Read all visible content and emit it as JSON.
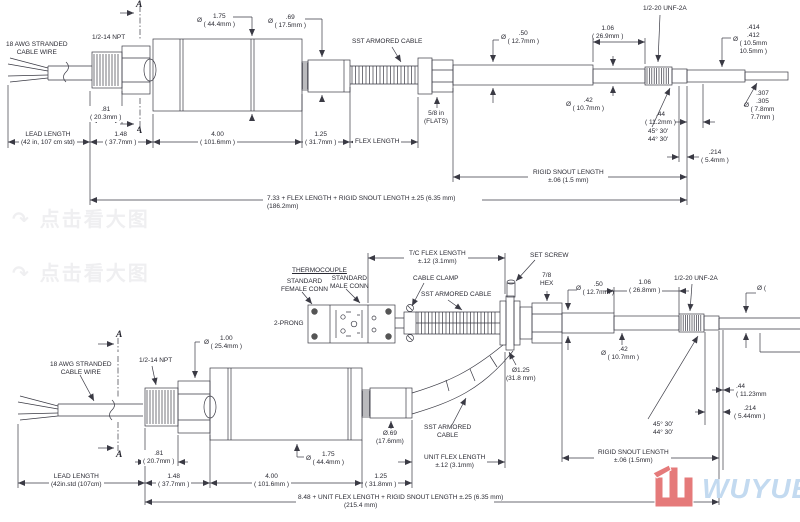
{
  "sym": {
    "dia": "Ø"
  },
  "watermark": {
    "icon": "↷",
    "text": "点击看大图"
  },
  "logo": {
    "text": "WUYUE"
  },
  "top": {
    "section_a": "A",
    "awg_l1": "18 AWG STRANDED",
    "awg_l2": "CABLE WIRE",
    "npt": "1/2-14 NPT",
    "d175_l1": "1.75",
    "d175_l2": "( 44.4mm )",
    "d69_l1": ".69",
    "d69_l2": "( 17.5mm )",
    "sst": "SST ARMORED CABLE",
    "d50_l1": ".50",
    "d50_l2": "( 12.7mm )",
    "l106_l1": "1.06",
    "l106_l2": "( 26.9mm )",
    "unf": "1/2-20 UNF-2A",
    "d414_l1": ".414",
    "d414_l2": ".412",
    "d414_l3": "( 10.5mm",
    "d414_l4": "10.5mm )",
    "d307_l1": ".307",
    "d307_l2": ".305",
    "d307_l3": "( 7.8mm",
    "d307_l4": "7.7mm )",
    "d42_l1": ".42",
    "d42_l2": "( 10.7mm )",
    "flats_l1": "5/8 in",
    "flats_l2": "(FLATS)",
    "l81_l1": ".81",
    "l81_l2": "( 20.3mm )",
    "lead_l1": "LEAD LENGTH",
    "lead_l2": "(42 in, 107 cm std)",
    "l148_l1": "1.48",
    "l148_l2": "( 37.7mm )",
    "l400_l1": "4.00",
    "l400_l2": "( 101.6mm )",
    "l125_l1": "1.25",
    "l125_l2": "( 31.7mm )",
    "flex": "FLEX LENGTH",
    "l44_l1": ".44",
    "l44_l2": "( 11.2mm )",
    "angle_l1": "45° 30'",
    "angle_l2": "44° 30'",
    "l214_l1": ".214",
    "l214_l2": "( 5.4mm )",
    "rigid_l1": "RIGID SNOUT LENGTH",
    "rigid_l2": "±.06 (1.5 mm)",
    "overall": "7.33 + FLEX LENGTH + RIGID SNOUT LENGTH ±.25 (6.35 mm)",
    "overall_mm": "(186.2mm)"
  },
  "bottom": {
    "section_a": "A",
    "tcflex_l1": "T/C FLEX LENGTH",
    "tcflex_l2": "±.12 (3.1mm)",
    "set_screw": "SET SCREW",
    "thermocouple": "THERMOCOUPLE",
    "female_l1": "STANDARD",
    "female_l2": "FEMALE CONN",
    "male_l1": "STANDARD",
    "male_l2": "MALE CONN",
    "clamp": "CABLE CLAMP",
    "sst": "SST ARMORED CABLE",
    "hex_l1": "7/8",
    "hex_l2": "HEX",
    "d50_l1": ".50",
    "d50_l2": "( 12.7mm )",
    "l106_l1": "1.06",
    "l106_l2": "( 26.8mm )",
    "unf": "1/2-20 UNF-2A",
    "prong": "2-PRONG",
    "d42_l1": ".42",
    "d42_l2": "( 10.7mm )",
    "d125_l1": "Ø1.25",
    "d125_l2": "(31.8 mm)",
    "edge_dia": "Ø (",
    "awg_l1": "18 AWG STRANDED",
    "awg_l2": "CABLE WIRE",
    "npt": "1/2-14 NPT",
    "d100_l1": "1.00",
    "d100_l2": "( 25.4mm )",
    "d175_l1": "1.75",
    "d175_l2": "( 44.4mm )",
    "d69_l1": "Ø.69",
    "d69_l2": "(17.6mm)",
    "sst2_l1": "SST ARMORED",
    "sst2_l2": "CABLE",
    "uflex_l1": "UNIT FLEX LENGTH",
    "uflex_l2": "±.12 (3.1mm)",
    "l81_l1": ".81",
    "l81_l2": "( 20.7mm )",
    "lead_l1": "LEAD LENGTH",
    "lead_l2": "(42in.std (107cm)",
    "l148_l1": "1.48",
    "l148_l2": "( 37.7mm )",
    "l400_l1": "4.00",
    "l400_l2": "( 101.6mm )",
    "l125_l1": "1.25",
    "l125_l2": "( 31.8mm )",
    "l44_l1": ".44",
    "l44_l2": "( 11.23mm",
    "l214_l1": ".214",
    "l214_l2": "( 5.44mm )",
    "angle_l1": "45° 30'",
    "angle_l2": "44° 30'",
    "rigid_l1": "RIGID SNOUT LENGTH",
    "rigid_l2": "±.06 (1.5mm)",
    "overall": "8.48 + UNIT FLEX LENGTH + RIGID SNOUT LENGTH ±.25 (6.35 mm)",
    "overall_mm": "(215.4 mm)"
  }
}
